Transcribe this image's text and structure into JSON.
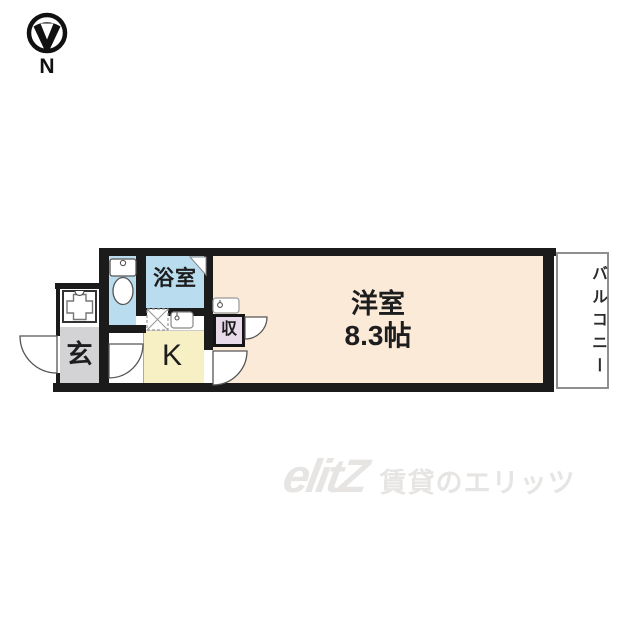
{
  "compass": {
    "label": "N",
    "icon": "compass-north-arrow-icon"
  },
  "floorplan": {
    "wall_color": "#1b1b1b",
    "rooms": [
      {
        "id": "genkan",
        "label": "玄",
        "color": "#d3d3d5"
      },
      {
        "id": "toilet",
        "label": "",
        "color": "#b9dcee"
      },
      {
        "id": "bathroom",
        "label": "浴室",
        "color": "#b9dcee"
      },
      {
        "id": "kitchen",
        "label": "K",
        "color": "#f8f0c5"
      },
      {
        "id": "closet",
        "label": "収",
        "color": "#e9daea"
      },
      {
        "id": "main_room",
        "label": "洋室",
        "size_label": "8.3帖",
        "color": "#fcead9"
      },
      {
        "id": "balcony",
        "label": "バルコニー",
        "color": "#ffffff"
      }
    ],
    "fixtures": [
      "washing-machine-pan-icon",
      "toilet-icon",
      "gas-stove-icon",
      "kitchen-sink-icon",
      "washbasin-icon"
    ]
  },
  "watermark": {
    "logo": "elitZ",
    "tagline": "賃貸のエリッツ",
    "color": "#e7e5e3"
  }
}
